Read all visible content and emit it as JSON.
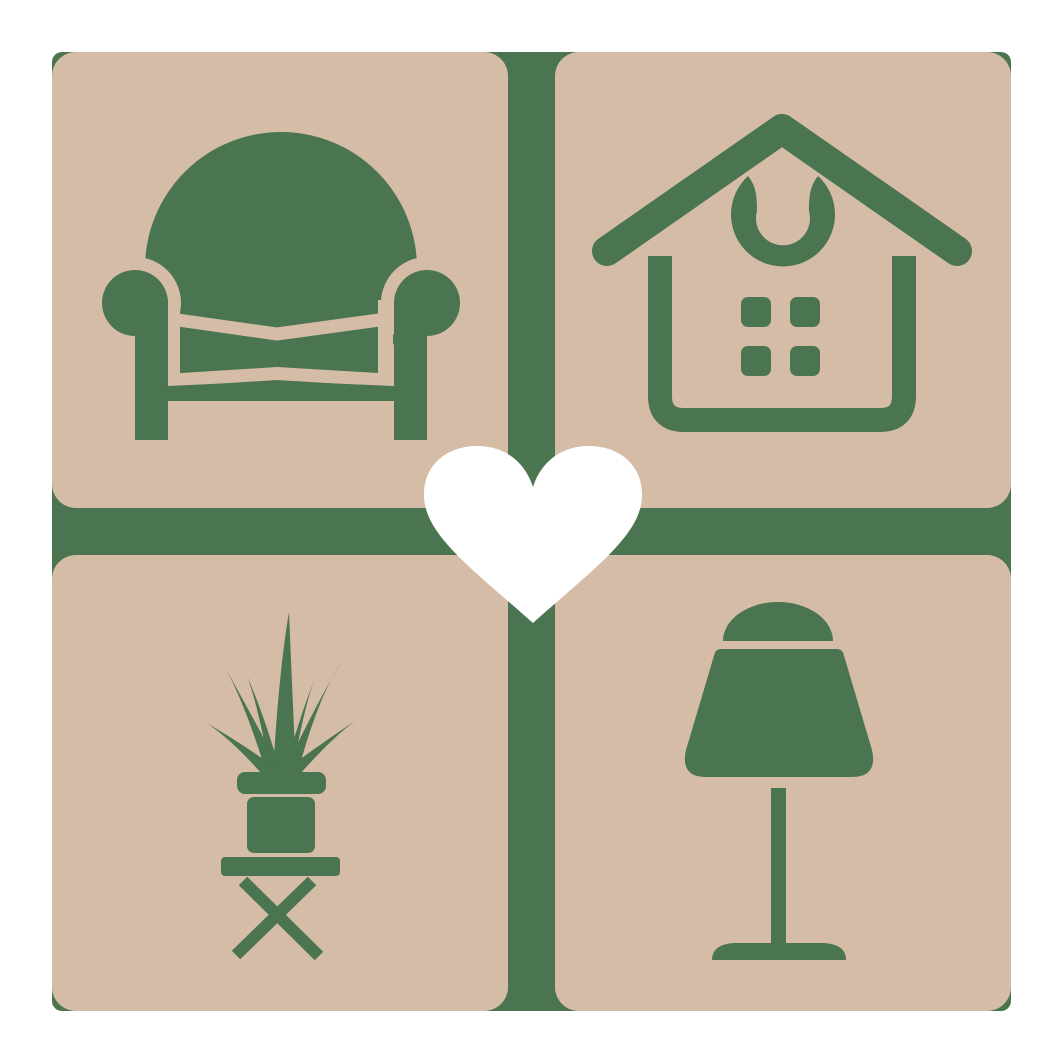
{
  "description": "Home decor logo: four rounded tan tiles in a 2x2 grid separated by a green cross, each tile holding a green furniture icon (armchair, house, potted plant on stool, table lamp), with a white heart at the center.",
  "colors": {
    "background": "#ffffff",
    "green": "#4a7550",
    "tan": "#d5bca6",
    "heart_white": "#ffffff"
  },
  "logo": {
    "grid": {
      "rows": 2,
      "cols": 2
    },
    "tiles": [
      {
        "position": "top-left",
        "icon": "armchair-icon",
        "subject": "armchair"
      },
      {
        "position": "top-right",
        "icon": "house-icon",
        "subject": "house with windows and wreath"
      },
      {
        "position": "bottom-left",
        "icon": "potted-plant-icon",
        "subject": "spiky potted plant on x-leg stool"
      },
      {
        "position": "bottom-right",
        "icon": "table-lamp-icon",
        "subject": "table lamp"
      }
    ],
    "center_icon": "heart-icon"
  }
}
